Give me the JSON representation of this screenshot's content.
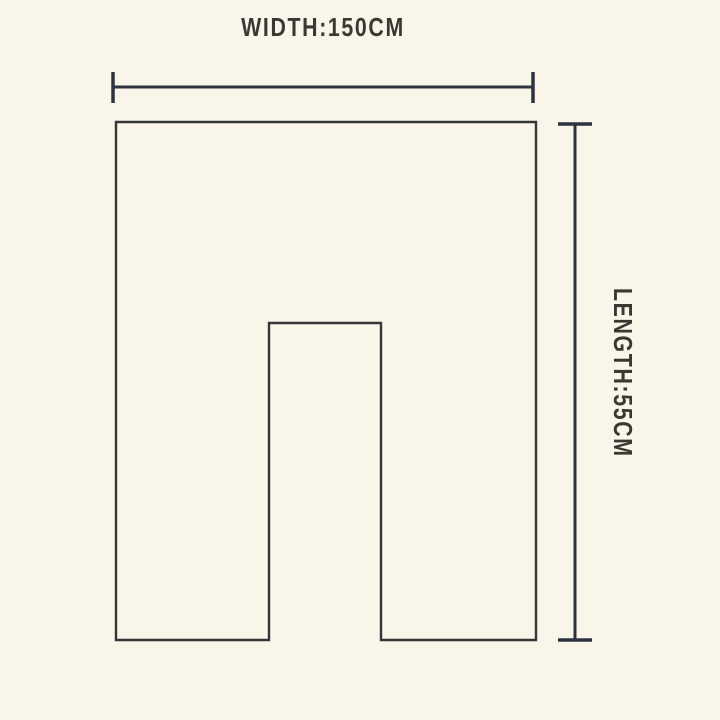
{
  "colors": {
    "background": "#f9f5e8",
    "outline": "#34363a",
    "dimension_line": "#2e3340",
    "label_text": "#3b3833"
  },
  "diagram": {
    "width_dimension": {
      "label": "WIDTH:150CM",
      "value_cm": 150
    },
    "length_dimension": {
      "label": "LENGTH:55CM",
      "value_cm": 55
    }
  }
}
